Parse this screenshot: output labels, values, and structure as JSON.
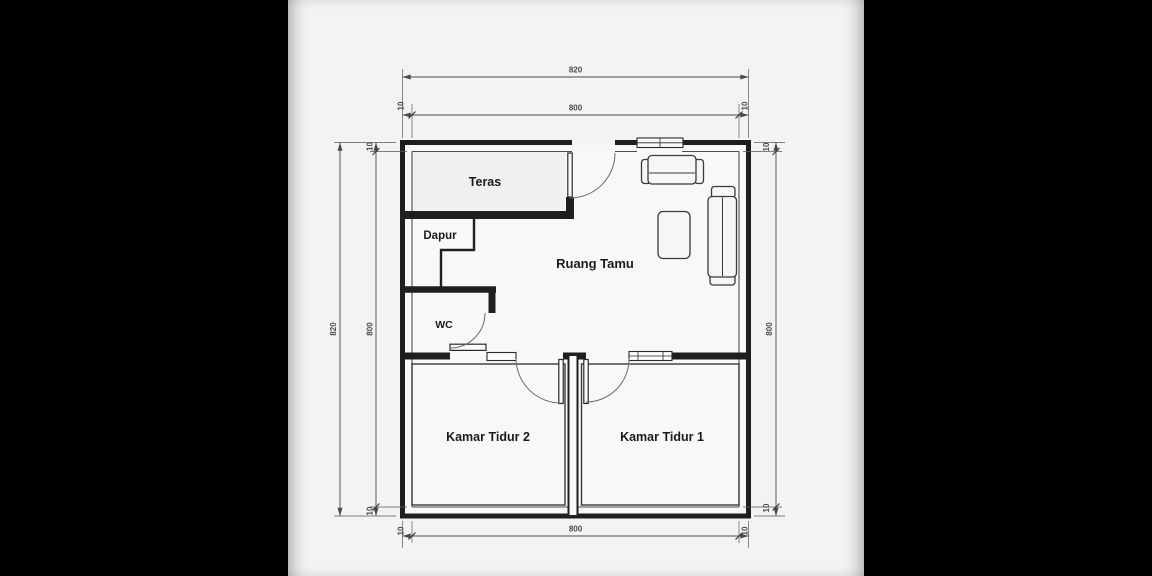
{
  "rooms": {
    "teras": "Teras",
    "dapur": "Dapur",
    "wc": "WC",
    "ruang_tamu": "Ruang Tamu",
    "kamar_tidur_2": "Kamar Tidur 2",
    "kamar_tidur_1": "Kamar Tidur 1"
  },
  "dimensions": {
    "top_overall": "820",
    "top_inner": "800",
    "left_overall": "820",
    "left_inner": "800",
    "right_inner": "800",
    "bottom_inner": "800",
    "wall_offset": "10"
  },
  "colors": {
    "letterbox": "#000000",
    "paper": "#f3f3f1",
    "wall_line": "#1f1f1f",
    "dimension_line": "#4a4a4a",
    "room_fill": "#f8f8f6",
    "teras_fill": "#f0f0ee",
    "label_text": "#1b1b1b"
  }
}
